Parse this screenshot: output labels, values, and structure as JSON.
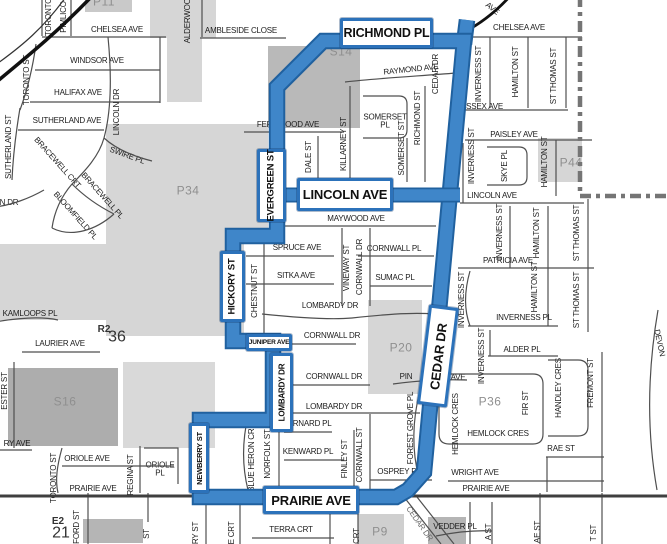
{
  "map": {
    "description": "Street map with highlighted route loop",
    "route": {
      "streets": [
        "RICHMOND PL",
        "CEDAR DR",
        "PRAIRIE AVE",
        "NEWBERRY ST",
        "LOMBARDY DR",
        "JUNIPER AVE",
        "HICKORY ST",
        "EVERGREEN ST",
        "LINCOLN AVE"
      ],
      "color_outer": "#20619f",
      "color_inner": "#3f86c9",
      "loop": [
        [
          277,
          87
        ],
        [
          323,
          41
        ],
        [
          464,
          41
        ],
        [
          424,
          472
        ],
        [
          408,
          490
        ],
        [
          396,
          497
        ],
        [
          200,
          497
        ],
        [
          200,
          420
        ],
        [
          273,
          420
        ],
        [
          273,
          341
        ],
        [
          233,
          341
        ],
        [
          233,
          236
        ],
        [
          277,
          236
        ]
      ],
      "crossbar": [
        [
          275,
          195
        ],
        [
          460,
          195
        ]
      ],
      "stub": [
        [
          464,
          44
        ],
        [
          467,
          20
        ]
      ]
    },
    "boundary": {
      "color": "#757575",
      "points": [
        [
          580,
          -4
        ],
        [
          580,
          196
        ],
        [
          670,
          196
        ]
      ]
    },
    "boxes": [
      {
        "id": "richmond-pl",
        "text": "RICHMOND PL",
        "x": 340,
        "y": 18,
        "w": 93,
        "h": 30,
        "o": "h",
        "fs": 12.5
      },
      {
        "id": "lincoln-ave",
        "text": "LINCOLN AVE",
        "x": 297,
        "y": 178,
        "w": 96,
        "h": 33,
        "o": "h",
        "fs": 13
      },
      {
        "id": "prairie-ave",
        "text": "PRAIRIE AVE",
        "x": 263,
        "y": 486,
        "w": 96,
        "h": 28,
        "o": "h",
        "fs": 13
      },
      {
        "id": "evergreen-st",
        "text": "EVERGREEN ST",
        "x": 257,
        "y": 149,
        "w": 29,
        "h": 73,
        "o": "v",
        "fs": 9.5
      },
      {
        "id": "hickory-st",
        "text": "HICKORY ST",
        "x": 220,
        "y": 251,
        "w": 25,
        "h": 71,
        "o": "v",
        "fs": 9.5
      },
      {
        "id": "lombardy-dr",
        "text": "LOMBARDY DR",
        "x": 270,
        "y": 353,
        "w": 23,
        "h": 79,
        "o": "v",
        "fs": 8
      },
      {
        "id": "newberry-st",
        "text": "NEWBERRY ST",
        "x": 189,
        "y": 423,
        "w": 20,
        "h": 70,
        "o": "v",
        "fs": 7.5
      },
      {
        "id": "juniper-ave",
        "text": "JUNIPER AVE",
        "x": 246,
        "y": 334,
        "w": 46,
        "h": 17,
        "o": "h",
        "fs": 6.5
      },
      {
        "id": "cedar-dr",
        "text": "CEDAR DR",
        "x": 423,
        "y": 306,
        "w": 30,
        "h": 100,
        "o": "v",
        "fs": 13,
        "tilt": 7
      }
    ],
    "labels": [
      {
        "id": "p11",
        "text": "P11",
        "x": 104,
        "y": 2,
        "cls": "area"
      },
      {
        "id": "toronto-v",
        "text": "TORONTO",
        "x": 49,
        "y": 17,
        "rot": -90
      },
      {
        "id": "pimlico",
        "text": "PIMLICO",
        "x": 64,
        "y": 17,
        "rot": -90
      },
      {
        "id": "chelsea-w",
        "text": "CHELSEA AVE",
        "x": 117,
        "y": 30
      },
      {
        "id": "alderwood",
        "text": "ALDERWOOD",
        "x": 188,
        "y": 18,
        "rot": -90
      },
      {
        "id": "ambleside",
        "text": "AMBLESIDE CLOSE",
        "x": 241,
        "y": 31
      },
      {
        "id": "toronto-st-n",
        "text": "TORONTO ST",
        "x": 27,
        "y": 80,
        "rot": -90
      },
      {
        "id": "windsor",
        "text": "WINDSOR AVE",
        "x": 97,
        "y": 61
      },
      {
        "id": "halifax",
        "text": "HALIFAX AVE",
        "x": 78,
        "y": 93
      },
      {
        "id": "lincoln-dr",
        "text": "LINCOLN DR",
        "x": 117,
        "y": 112,
        "rot": -90
      },
      {
        "id": "sutherland-ave",
        "text": "SUTHERLAND AVE",
        "x": 67,
        "y": 121
      },
      {
        "id": "sutherland-st",
        "text": "SUTHERLAND ST",
        "x": 9,
        "y": 147,
        "rot": -90
      },
      {
        "id": "swire",
        "text": "SWIRE PL",
        "x": 127,
        "y": 156,
        "rot": 20
      },
      {
        "id": "bracewell-crt",
        "text": "BRACEWELL CRT",
        "x": 57,
        "y": 163,
        "rot": 48
      },
      {
        "id": "bracewell-pl",
        "text": "BRACEWELL PL",
        "x": 102,
        "y": 196,
        "rot": 48
      },
      {
        "id": "bloomfield-pl",
        "text": "BLOOMFIELD PL",
        "x": 75,
        "y": 216,
        "rot": 48
      },
      {
        "id": "n-dr",
        "text": "N DR",
        "x": 9,
        "y": 203
      },
      {
        "id": "s14",
        "text": "S14",
        "x": 341,
        "y": 52,
        "cls": "area"
      },
      {
        "id": "raymond",
        "text": "RAYMOND AVE",
        "x": 411,
        "y": 70,
        "rot": -6
      },
      {
        "id": "fernwood",
        "text": "FERNWOOD AVE",
        "x": 288,
        "y": 125,
        "under": true
      },
      {
        "id": "dale-st",
        "text": "DALE ST",
        "x": 309,
        "y": 157,
        "rot": -90
      },
      {
        "id": "killarney",
        "text": "KILLARNEY ST",
        "x": 344,
        "y": 144,
        "rot": -90
      },
      {
        "id": "somerset-pl",
        "text": "SOMERSET\nPL",
        "x": 385,
        "y": 122
      },
      {
        "id": "somerset-st",
        "text": "SOMERSET ST",
        "x": 402,
        "y": 148,
        "rot": -90
      },
      {
        "id": "richmond-st",
        "text": "RICHMOND ST",
        "x": 418,
        "y": 118,
        "rot": -90
      },
      {
        "id": "cedar-dr-n",
        "text": "CEDAR DR",
        "x": 436,
        "y": 74,
        "rot": -90
      },
      {
        "id": "cedar-dr-mid",
        "text": "CEDAR DR",
        "x": 448,
        "y": 227,
        "rot": -88,
        "color": "#c2cede"
      },
      {
        "id": "ave-ne",
        "text": "AVE",
        "x": 492,
        "y": 9,
        "rot": 38
      },
      {
        "id": "chelsea-e",
        "text": "CHELSEA AVE",
        "x": 519,
        "y": 28
      },
      {
        "id": "inverness-ne",
        "text": "INVERNESS ST",
        "x": 479,
        "y": 74,
        "rot": -90
      },
      {
        "id": "hamilton-ne",
        "text": "HAMILTON ST",
        "x": 516,
        "y": 72,
        "rot": -90
      },
      {
        "id": "stthomas-ne",
        "text": "ST THOMAS ST",
        "x": 554,
        "y": 76,
        "rot": -90
      },
      {
        "id": "essex",
        "text": "ESSEX AVE",
        "x": 482,
        "y": 107
      },
      {
        "id": "paisley",
        "text": "PAISLEY AVE",
        "x": 514,
        "y": 135
      },
      {
        "id": "inverness-2",
        "text": "INVERNESS ST",
        "x": 472,
        "y": 156,
        "rot": -90
      },
      {
        "id": "skye",
        "text": "SKYE PL",
        "x": 505,
        "y": 166,
        "rot": -90
      },
      {
        "id": "hamilton-2",
        "text": "HAMILTON ST",
        "x": 545,
        "y": 162,
        "rot": -90
      },
      {
        "id": "p44",
        "text": "P44",
        "x": 571,
        "y": 163,
        "cls": "area"
      },
      {
        "id": "lincoln-e",
        "text": "LINCOLN AVE",
        "x": 492,
        "y": 196
      },
      {
        "id": "inverness-3",
        "text": "INVERNESS ST",
        "x": 500,
        "y": 232,
        "rot": -90
      },
      {
        "id": "hamilton-3",
        "text": "HAMILTON ST",
        "x": 537,
        "y": 233,
        "rot": -90
      },
      {
        "id": "stthomas-2",
        "text": "ST THOMAS ST",
        "x": 577,
        "y": 233,
        "rot": -90
      },
      {
        "id": "patricia",
        "text": "PATRICIA AVE",
        "x": 508,
        "y": 261
      },
      {
        "id": "p34",
        "text": "P34",
        "x": 188,
        "y": 191,
        "cls": "area"
      },
      {
        "id": "maywood",
        "text": "MAYWOOD AVE",
        "x": 356,
        "y": 219
      },
      {
        "id": "spruce",
        "text": "SPRUCE AVE",
        "x": 297,
        "y": 248
      },
      {
        "id": "cornwall-pl",
        "text": "CORNWALL PL",
        "x": 394,
        "y": 249
      },
      {
        "id": "sitka",
        "text": "SITKA AVE",
        "x": 296,
        "y": 276
      },
      {
        "id": "sumac",
        "text": "SUMAC PL",
        "x": 395,
        "y": 278
      },
      {
        "id": "vineway",
        "text": "VINEWAY ST",
        "x": 347,
        "y": 268,
        "rot": -90
      },
      {
        "id": "cornwall-dr-v",
        "text": "CORNWALL DR",
        "x": 360,
        "y": 267,
        "rot": -90
      },
      {
        "id": "chestnut",
        "text": "CHESTNUT ST",
        "x": 255,
        "y": 291,
        "rot": -90
      },
      {
        "id": "lombardy-1",
        "text": "LOMBARDY DR",
        "x": 330,
        "y": 306
      },
      {
        "id": "cornwall-1",
        "text": "CORNWALL DR",
        "x": 332,
        "y": 336
      },
      {
        "id": "inverness-4",
        "text": "INVERNESS ST",
        "x": 462,
        "y": 300,
        "rot": -90
      },
      {
        "id": "inverness-5",
        "text": "INVERNESS ST",
        "x": 482,
        "y": 356,
        "rot": -90
      },
      {
        "id": "hamilton-4",
        "text": "HAMILTON ST",
        "x": 535,
        "y": 287,
        "rot": -90
      },
      {
        "id": "stthomas-3",
        "text": "ST THOMAS ST",
        "x": 577,
        "y": 300,
        "rot": -90
      },
      {
        "id": "inverness-pl",
        "text": "INVERNESS PL",
        "x": 524,
        "y": 318
      },
      {
        "id": "alder",
        "text": "ALDER PL",
        "x": 522,
        "y": 350
      },
      {
        "id": "kamloops",
        "text": "KAMLOOPS PL",
        "x": 30,
        "y": 314
      },
      {
        "id": "r2",
        "text": "R2",
        "x": 104,
        "y": 330,
        "cls": "ref-sm"
      },
      {
        "id": "n36",
        "text": "36",
        "x": 117,
        "y": 338,
        "cls": "ref-lg"
      },
      {
        "id": "laurier",
        "text": "LAURIER AVE",
        "x": 60,
        "y": 344
      },
      {
        "id": "p20",
        "text": "P20",
        "x": 401,
        "y": 348,
        "cls": "area"
      },
      {
        "id": "cornwall-2",
        "text": "CORNWALL DR",
        "x": 334,
        "y": 377
      },
      {
        "id": "pin-frag",
        "text": "PIN",
        "x": 406,
        "y": 377,
        "under": true
      },
      {
        "id": "ave-frag",
        "text": "AVE",
        "x": 458,
        "y": 378
      },
      {
        "id": "p36",
        "text": "P36",
        "x": 490,
        "y": 402,
        "cls": "area"
      },
      {
        "id": "fir",
        "text": "FIR ST",
        "x": 526,
        "y": 403,
        "rot": -90
      },
      {
        "id": "handley",
        "text": "HANDLEY CRES",
        "x": 559,
        "y": 388,
        "rot": -90
      },
      {
        "id": "fremont",
        "text": "FREMONT ST",
        "x": 591,
        "y": 383,
        "rot": -90
      },
      {
        "id": "devon",
        "text": "DEVON",
        "x": 659,
        "y": 343,
        "rot": 78
      },
      {
        "id": "s16",
        "text": "S16",
        "x": 65,
        "y": 402,
        "cls": "area"
      },
      {
        "id": "ry-ave",
        "text": "RY AVE",
        "x": 17,
        "y": 444
      },
      {
        "id": "ester",
        "text": "ESTER ST",
        "x": 5,
        "y": 391,
        "rot": -90
      },
      {
        "id": "lombardy-2",
        "text": "LOMBARDY DR",
        "x": 334,
        "y": 407
      },
      {
        "id": "bernard",
        "text": "BERNARD PL",
        "x": 307,
        "y": 424
      },
      {
        "id": "kenward",
        "text": "KENWARD PL",
        "x": 308,
        "y": 452
      },
      {
        "id": "blue-heron",
        "text": "BLUE HERON CRES",
        "x": 252,
        "y": 455,
        "rot": -90
      },
      {
        "id": "norfolk",
        "text": "NORFOLK ST",
        "x": 268,
        "y": 454,
        "rot": -90
      },
      {
        "id": "finley",
        "text": "FINLEY ST",
        "x": 345,
        "y": 459,
        "rot": -90
      },
      {
        "id": "cornwall-st",
        "text": "CORNWALL ST",
        "x": 360,
        "y": 455,
        "rot": -90
      },
      {
        "id": "forest-grove",
        "text": "FOREST GROVE PL",
        "x": 411,
        "y": 428,
        "rot": -90
      },
      {
        "id": "osprey",
        "text": "OSPREY PL",
        "x": 399,
        "y": 472
      },
      {
        "id": "hemlock-v",
        "text": "HEMLOCK CRES",
        "x": 456,
        "y": 424,
        "rot": -90
      },
      {
        "id": "hemlock-h",
        "text": "HEMLOCK CRES",
        "x": 498,
        "y": 434
      },
      {
        "id": "rae",
        "text": "RAE ST",
        "x": 561,
        "y": 449
      },
      {
        "id": "wright",
        "text": "WRIGHT AVE",
        "x": 475,
        "y": 473
      },
      {
        "id": "oriole-ave",
        "text": "ORIOLE AVE",
        "x": 87,
        "y": 459
      },
      {
        "id": "regina",
        "text": "REGINA ST",
        "x": 131,
        "y": 475,
        "rot": -90
      },
      {
        "id": "oriole-pl",
        "text": "ORIOLE\nPL",
        "x": 160,
        "y": 470
      },
      {
        "id": "toronto-s",
        "text": "TORONTO ST",
        "x": 54,
        "y": 478,
        "rot": -90
      },
      {
        "id": "prairie-w",
        "text": "PRAIRIE AVE",
        "x": 93,
        "y": 489
      },
      {
        "id": "prairie-e",
        "text": "PRAIRIE AVE",
        "x": 486,
        "y": 489
      },
      {
        "id": "e2",
        "text": "E2",
        "x": 58,
        "y": 522,
        "cls": "ref-sm"
      },
      {
        "id": "n21",
        "text": "21",
        "x": 61,
        "y": 534,
        "cls": "ref-lg"
      },
      {
        "id": "ford",
        "text": "FORD ST",
        "x": 77,
        "y": 527,
        "rot": -90
      },
      {
        "id": "st-frag",
        "text": "ST",
        "x": 147,
        "y": 534,
        "rot": -90
      },
      {
        "id": "ry-st",
        "text": "RY ST",
        "x": 196,
        "y": 533,
        "rot": -90
      },
      {
        "id": "e-crt",
        "text": "E CRT",
        "x": 232,
        "y": 533,
        "rot": -90
      },
      {
        "id": "terra",
        "text": "TERRA CRT",
        "x": 291,
        "y": 530
      },
      {
        "id": "crt-frag",
        "text": "CRT",
        "x": 357,
        "y": 536,
        "rot": -90
      },
      {
        "id": "p9",
        "text": "P9",
        "x": 380,
        "y": 532,
        "cls": "area"
      },
      {
        "id": "cedar-diag",
        "text": "CEDAR DR",
        "x": 419,
        "y": 524,
        "rot": 55,
        "color": "#6a6a6a"
      },
      {
        "id": "vedder",
        "text": "VEDDER PL",
        "x": 455,
        "y": 527
      },
      {
        "id": "a-st",
        "text": "A ST",
        "x": 489,
        "y": 532,
        "rot": -90
      },
      {
        "id": "ae-st",
        "text": "AE ST",
        "x": 538,
        "y": 532,
        "rot": -90
      },
      {
        "id": "t-st",
        "text": "T ST",
        "x": 594,
        "y": 533,
        "rot": -90
      }
    ],
    "gray_areas": [
      {
        "x": 85,
        "y": 0,
        "w": 47,
        "h": 12,
        "c": "#c9c9c9"
      },
      {
        "x": 150,
        "y": 0,
        "w": 66,
        "h": 38,
        "c": "#d6d6d6"
      },
      {
        "x": 167,
        "y": 36,
        "w": 35,
        "h": 66,
        "c": "#d6d6d6"
      },
      {
        "x": 268,
        "y": 46,
        "w": 92,
        "h": 82,
        "c": "#b9b9b9"
      },
      {
        "x": 106,
        "y": 124,
        "w": 162,
        "h": 108,
        "c": "#d6d6d6"
      },
      {
        "x": 106,
        "y": 230,
        "w": 138,
        "h": 106,
        "c": "#d6d6d6"
      },
      {
        "x": 0,
        "y": 244,
        "w": 108,
        "h": 76,
        "c": "#d6d6d6"
      },
      {
        "x": 538,
        "y": 138,
        "w": 44,
        "h": 44,
        "c": "#d6d6d6"
      },
      {
        "x": 368,
        "y": 300,
        "w": 54,
        "h": 94,
        "c": "#d6d6d6"
      },
      {
        "x": 8,
        "y": 368,
        "w": 110,
        "h": 78,
        "c": "#adadad"
      },
      {
        "x": 123,
        "y": 362,
        "w": 92,
        "h": 86,
        "c": "#d9d9d9"
      },
      {
        "x": 83,
        "y": 519,
        "w": 60,
        "h": 24,
        "c": "#b5b5b5"
      },
      {
        "x": 358,
        "y": 514,
        "w": 46,
        "h": 30,
        "c": "#cfcfcf"
      },
      {
        "x": 428,
        "y": 517,
        "w": 38,
        "h": 27,
        "c": "#b5b5b5"
      }
    ]
  }
}
